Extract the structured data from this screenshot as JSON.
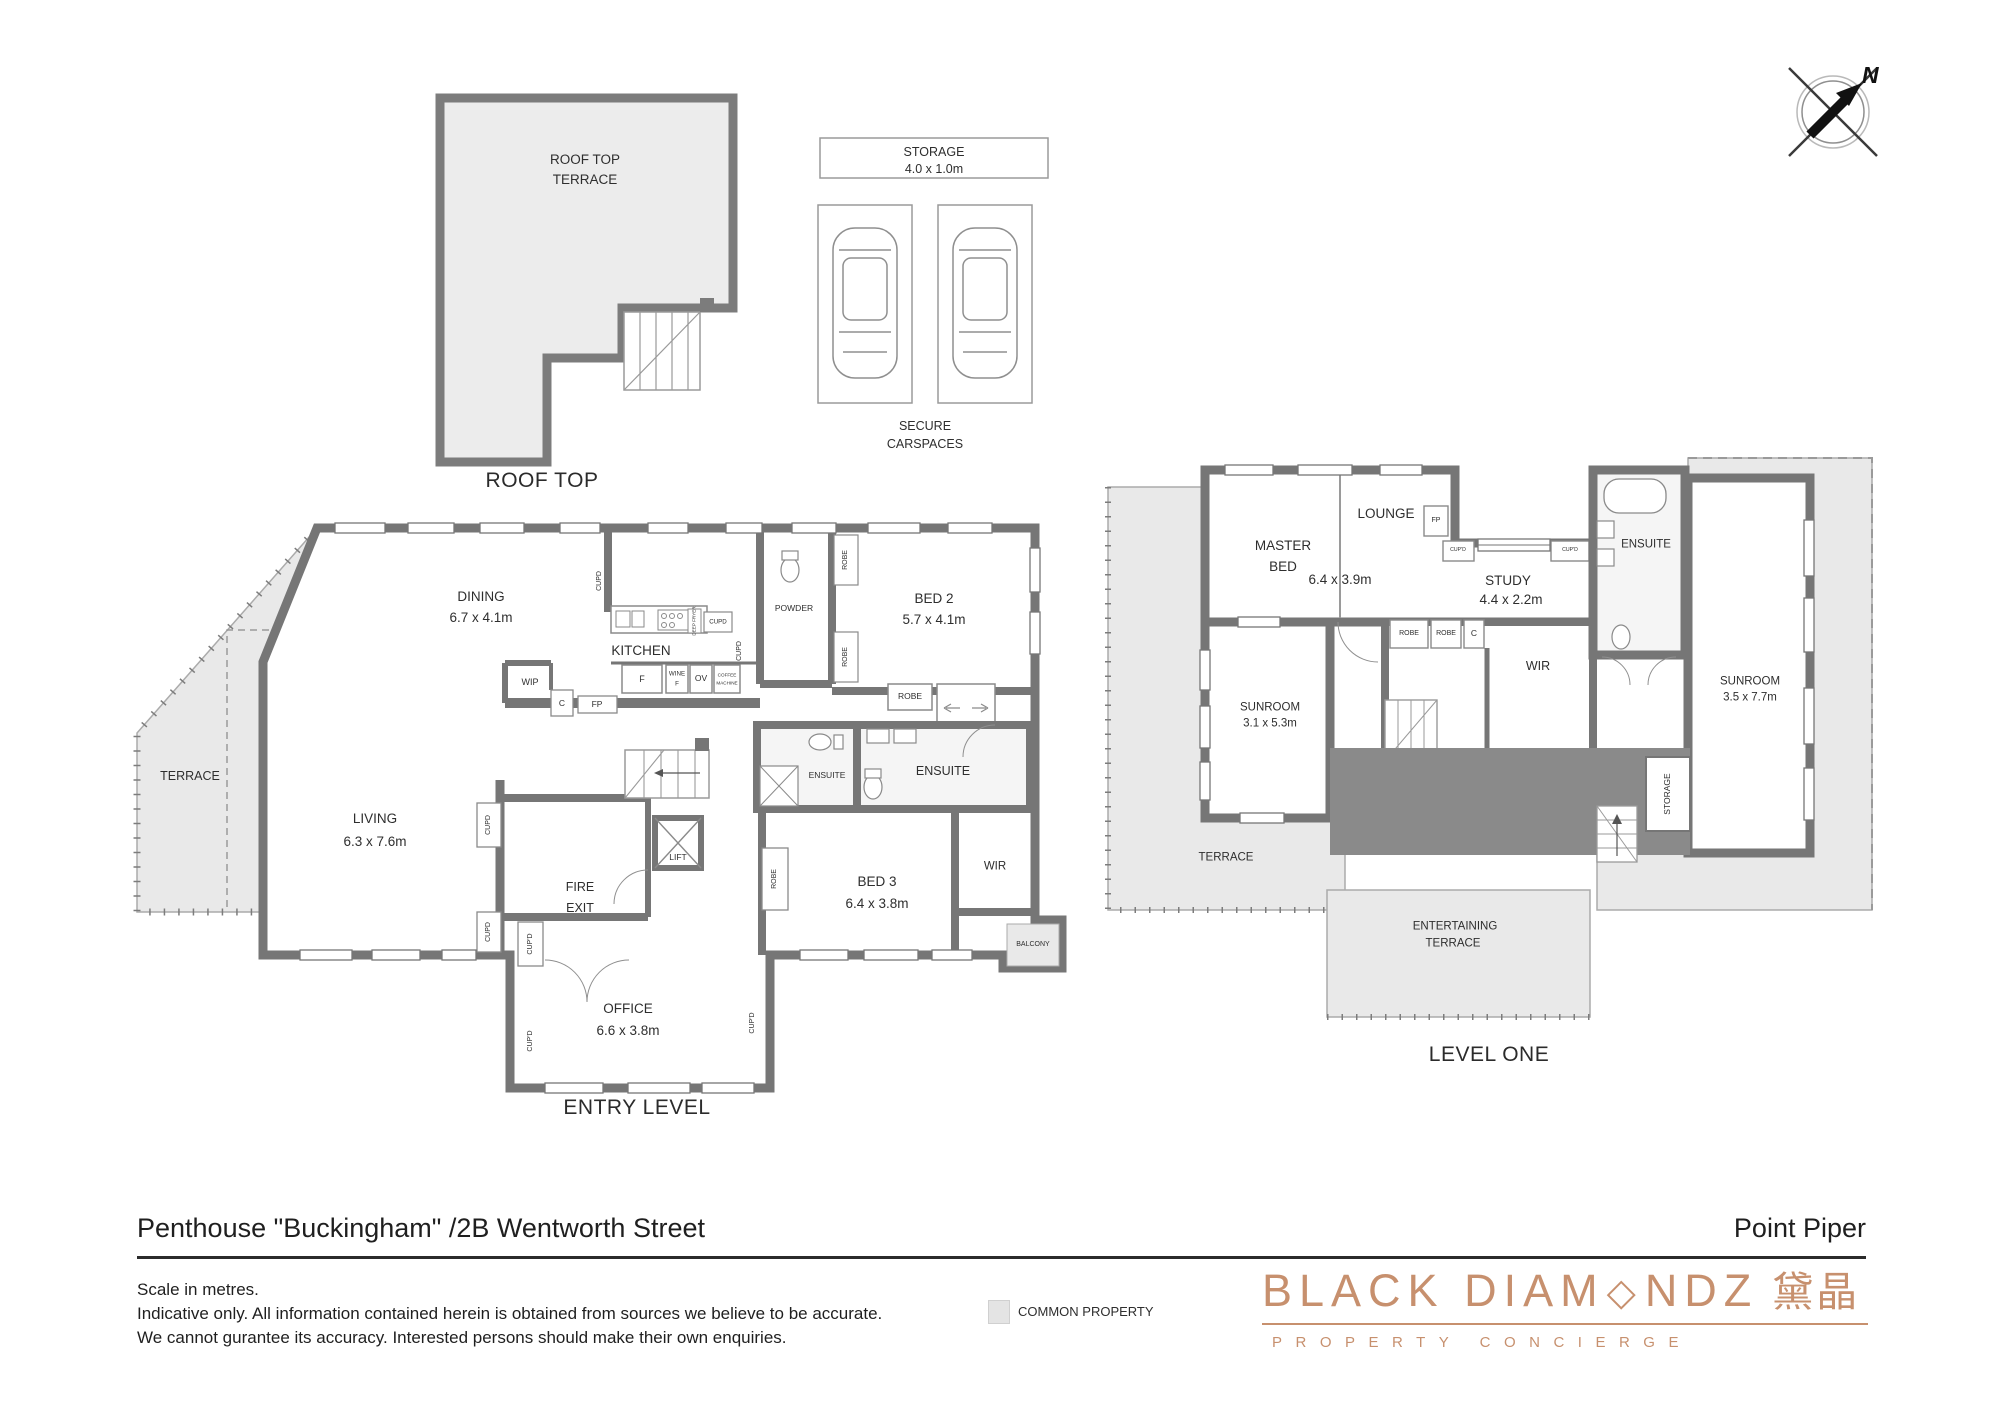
{
  "header": {
    "title": "Penthouse \"Buckingham\" /2B Wentworth Street",
    "suburb": "Point Piper"
  },
  "footer": {
    "disclaimer_line1": "Scale in metres.",
    "disclaimer_line2": "Indicative only. All information contained herein is obtained from sources we believe to be accurate.",
    "disclaimer_line3": "We cannot gurantee its accuracy. Interested persons should make their own enquiries.",
    "legend_common_property": "COMMON PROPERTY"
  },
  "logo": {
    "part1": "BLACK DIAM",
    "diamond": "◇",
    "part2": "NDZ",
    "chinese": "黛晶",
    "tagline": "PROPERTY CONCIERGE",
    "color": "#c7906e"
  },
  "compass": {
    "north": "N"
  },
  "roof_top": {
    "room_line1": "ROOF TOP",
    "room_line2": "TERRACE",
    "caption": "ROOF TOP"
  },
  "parking": {
    "storage": "STORAGE",
    "storage_dims": "4.0 x 1.0m",
    "caption_line1": "SECURE",
    "caption_line2": "CARSPACES"
  },
  "entry": {
    "caption": "ENTRY LEVEL",
    "dining": {
      "name": "DINING",
      "dims": "6.7 x 4.1m"
    },
    "kitchen": {
      "name": "KITCHEN"
    },
    "bed2": {
      "name": "BED 2",
      "dims": "5.7 x 4.1m"
    },
    "powder": "POWDER",
    "terrace": "TERRACE",
    "living": {
      "name": "LIVING",
      "dims": "6.3 x 7.6m"
    },
    "fire_exit": {
      "line1": "FIRE",
      "line2": "EXIT"
    },
    "lift": "LIFT",
    "ensuite_small": "ENSUITE",
    "ensuite_main": "ENSUITE",
    "bed3": {
      "name": "BED 3",
      "dims": "6.4 x 3.8m"
    },
    "wir": "WIR",
    "office": {
      "name": "OFFICE",
      "dims": "6.6 x 3.8m"
    },
    "balcony": "BALCONY",
    "fixtures": {
      "wip": "WIP",
      "c": "C",
      "fp": "FP",
      "fridge": "F",
      "wine_line1": "WINE",
      "wine_line2": "F",
      "oven": "OV",
      "coffee_line1": "COFFEE",
      "coffee_line2": "MACHINE",
      "deep_fryer": "DEEP FRYER"
    }
  },
  "level_one": {
    "caption": "LEVEL ONE",
    "master": {
      "line1": "MASTER",
      "line2": "BED",
      "dims": "6.4 x 3.9m"
    },
    "lounge": "LOUNGE",
    "fp": "FP",
    "study": {
      "name": "STUDY",
      "dims": "4.4 x 2.2m"
    },
    "ensuite": "ENSUITE",
    "sunroom1": {
      "name": "SUNROOM",
      "dims": "3.1 x 5.3m"
    },
    "sunroom2": {
      "name": "SUNROOM",
      "dims": "3.5 x 7.7m"
    },
    "wir": "WIR",
    "c": "C",
    "terrace": "TERRACE",
    "entertaining": {
      "line1": "ENTERTAINING",
      "line2": "TERRACE"
    },
    "storage": "STORAGE"
  },
  "labels": {
    "robe": "ROBE",
    "cupd": "CUPD",
    "cupd_ap": "CUP'D"
  },
  "colors": {
    "wall": "#767676",
    "common_property_fill": "#e9e9e9",
    "dark_roof_fill": "#8a8a8a",
    "logo_rose": "#c7906e"
  }
}
